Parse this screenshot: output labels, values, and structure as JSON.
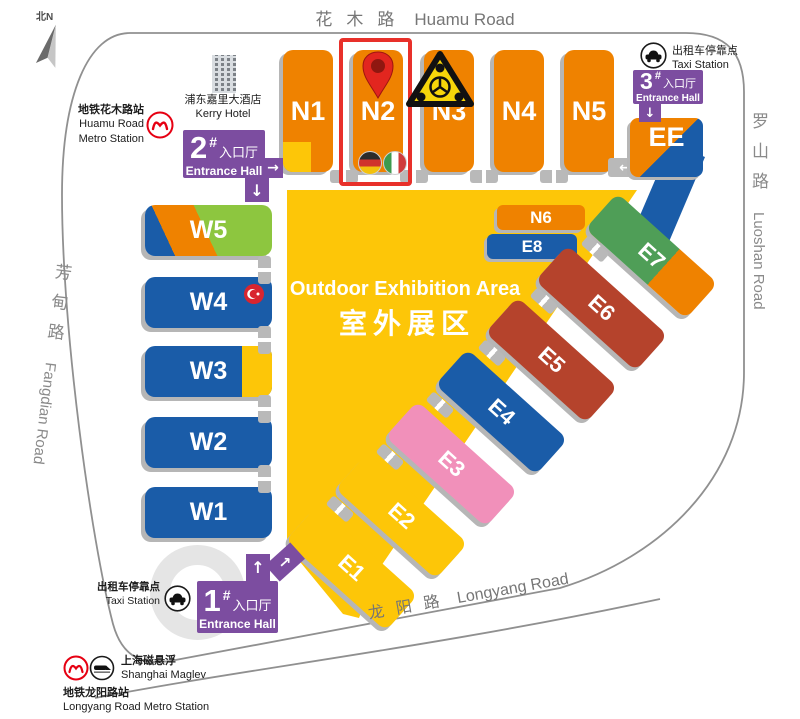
{
  "compass": {
    "label": "北N"
  },
  "roads": {
    "huamu": {
      "zh": "花木路",
      "en": "Huamu Road"
    },
    "luoshan": {
      "zh": "罗山路",
      "en": "Luoshan Road"
    },
    "fangdian": {
      "zh": "芳甸路",
      "en": "Fangdian Road"
    },
    "longyang": {
      "zh": "龙阳路",
      "en": "Longyang Road"
    }
  },
  "halls": {
    "n1": "N1",
    "n2": "N2",
    "n3": "N3",
    "n4": "N4",
    "n5": "N5",
    "n6": "N6",
    "w1": "W1",
    "w2": "W2",
    "w3": "W3",
    "w4": "W4",
    "w5": "W5",
    "e1": "E1",
    "e2": "E2",
    "e3": "E3",
    "e4": "E4",
    "e5": "E5",
    "e6": "E6",
    "e7": "E7",
    "e8": "E8",
    "ee": "EE"
  },
  "outdoor": {
    "en": "Outdoor Exhibition Area",
    "zh": "室外展区"
  },
  "entrances": {
    "one": {
      "num": "1",
      "hash": "#",
      "zh": "入口厅",
      "en": "Entrance Hall"
    },
    "two": {
      "num": "2",
      "hash": "#",
      "zh": "入口厅",
      "en": "Entrance Hall"
    },
    "three": {
      "num": "3",
      "hash": "#",
      "zh": "入口厅",
      "en": "Entrance Hall"
    }
  },
  "stations": {
    "huamu_metro": {
      "zh": "地铁花木路站",
      "en1": "Huamu Road",
      "en2": "Metro Station"
    },
    "kerry_hotel": {
      "zh": "浦东嘉里大酒店",
      "en": "Kerry Hotel"
    },
    "taxi_ne": {
      "zh": "出租车停靠点",
      "en": "Taxi Station"
    },
    "taxi_sw": {
      "zh": "出租车停靠点",
      "en": "Taxi Station"
    },
    "maglev": {
      "zh": "上海磁悬浮",
      "en": "Shanghai Maglev"
    },
    "longyang_metro": {
      "zh": "地铁龙阳路站",
      "en": "Longyang Road Metro Station"
    }
  },
  "arrows": {
    "up": "↑",
    "down": "↓",
    "left": "←",
    "right": "→",
    "up_right": "→",
    "down_left": "↙"
  },
  "icons": {
    "metro_logo": "shanghai-metro-roundel",
    "taxi": "car-in-circle",
    "maglev": "train-in-circle",
    "hotel": "building",
    "compass": "north-arrow",
    "pin": "red-location-pin",
    "hazard": "yellow-triangle-wheel-symbol",
    "flags_n2": [
      "germany",
      "italy"
    ],
    "flag_w4": "turkey"
  },
  "colors": {
    "orange": "#ef8200",
    "yellow": "#fdc608",
    "blue": "#1a5ca8",
    "brick": "#b5432c",
    "green": "#4f9e57",
    "lime": "#8dc63f",
    "purple": "#7c4da0",
    "pink": "#f190ba",
    "highlight_red": "#e8302a",
    "tab_gray": "#b9b9b9"
  }
}
